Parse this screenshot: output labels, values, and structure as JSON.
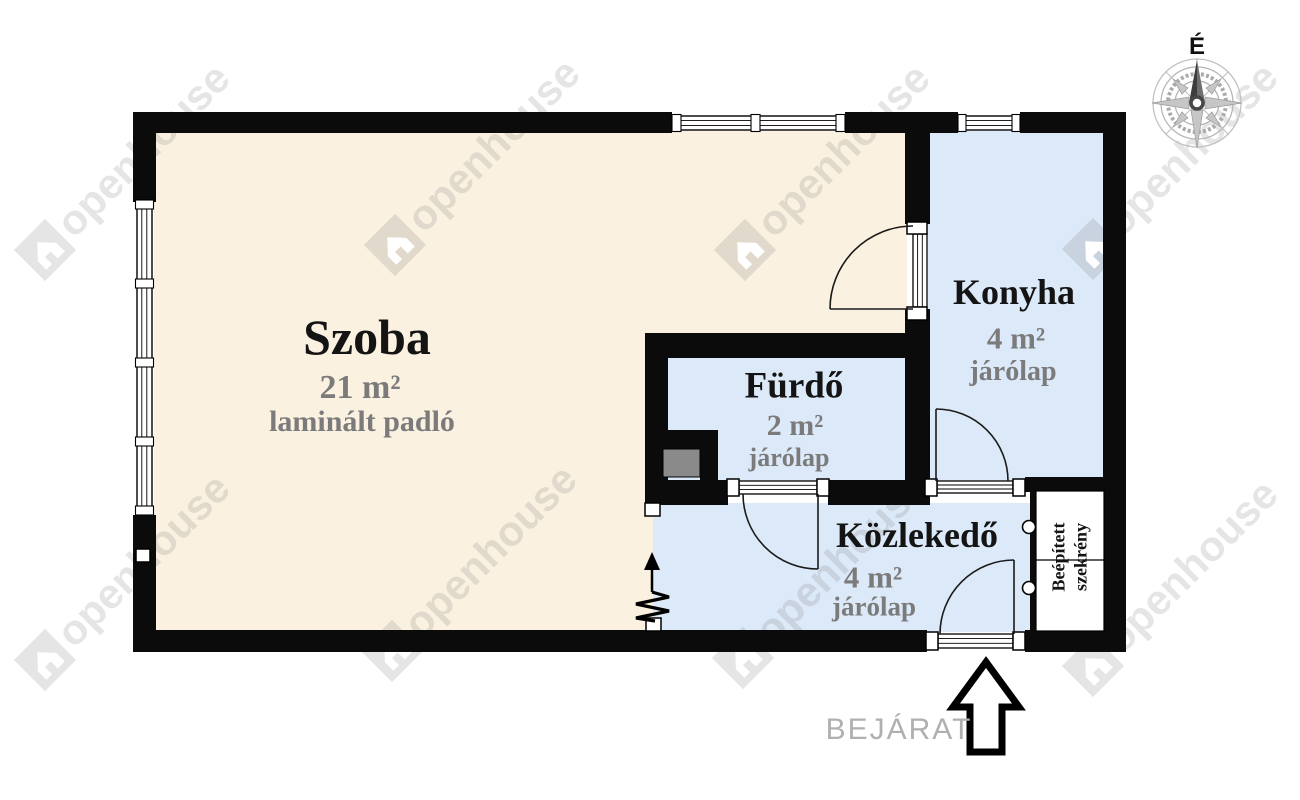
{
  "plan": {
    "rooms": [
      {
        "id": "szoba",
        "name": "Szoba",
        "area": "21 m²",
        "floor": "laminált padló"
      },
      {
        "id": "konyha",
        "name": "Konyha",
        "area": "4 m²",
        "floor": "járólap"
      },
      {
        "id": "furdo",
        "name": "Fürdő",
        "area": "2 m²",
        "floor": "járólap"
      },
      {
        "id": "kozlekedo",
        "name": "Közlekedő",
        "area": "4 m²",
        "floor": "járólap"
      }
    ],
    "closet_label": "Beépített szekrény",
    "entrance_label": "BEJÁRAT",
    "compass_north": "É"
  },
  "watermark": {
    "text": "openhouse"
  },
  "colors": {
    "room_floor_cream": "#FBF1E0",
    "wet_room_blue": "#DCE9F8",
    "wall_black": "#0B0B0B",
    "label_gray": "#7B7B7B",
    "entrance_gray": "#B0B0B0",
    "shaft_gray": "#8A8A8A",
    "watermark_gray": "#9a9a9a"
  }
}
